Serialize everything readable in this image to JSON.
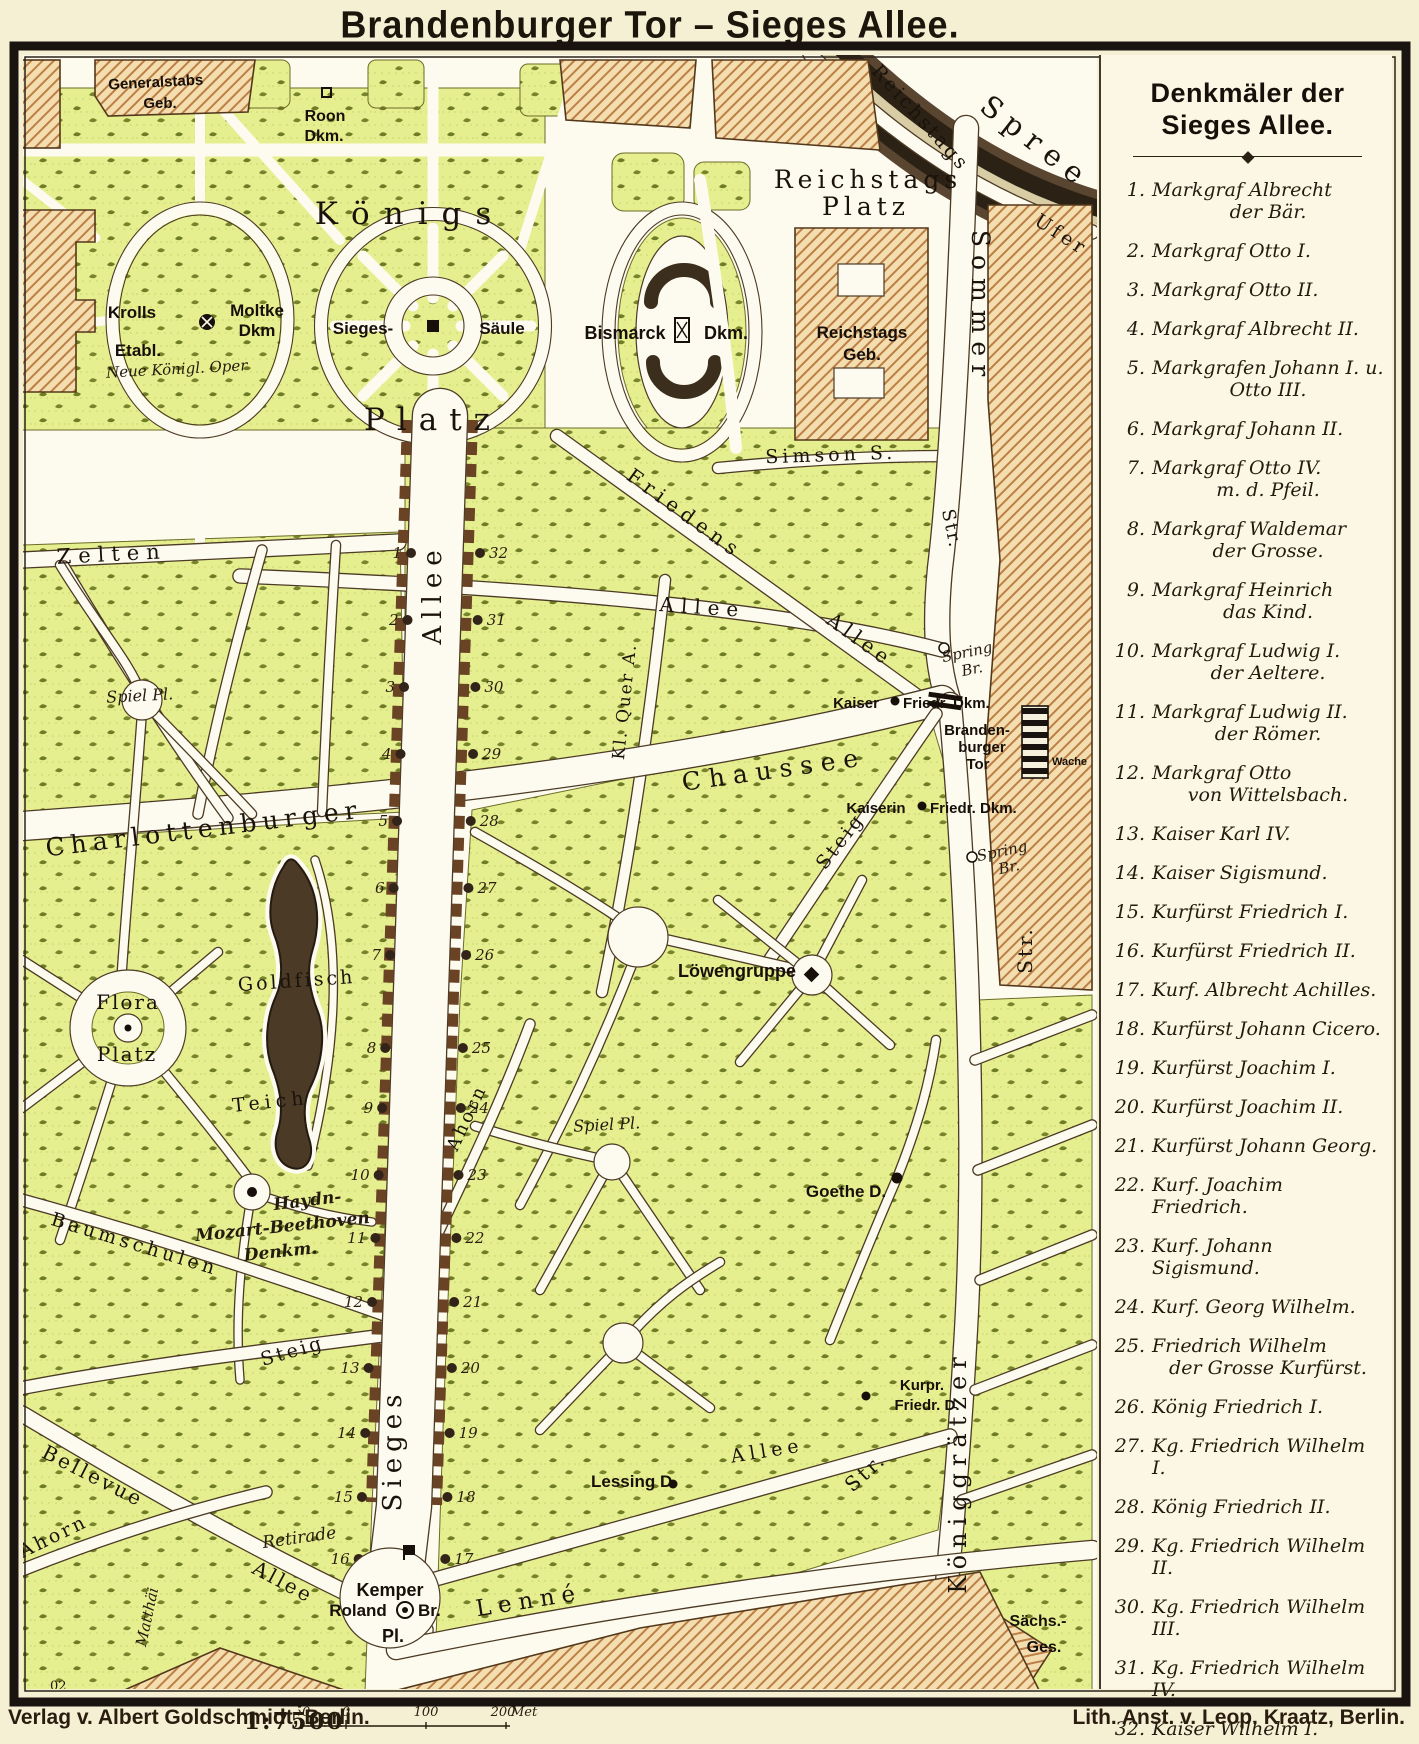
{
  "title": "Brandenburger Tor – Sieges Allee.",
  "colors": {
    "paper": "#f5efd3",
    "map_ground": "#fdfaee",
    "park_green": "#e6ef8f",
    "building_tan": "#f4deb0",
    "hatch_line": "#bc7f46",
    "river_dark": "#2b2115",
    "street_white": "#fdfbf0",
    "ink": "#1a130c",
    "pond": "#4a3a26"
  },
  "legend": {
    "title_line1": "Denkmäler der",
    "title_line2": "Sieges Allee.",
    "items": [
      {
        "n": "1.",
        "t": "Markgraf Albrecht",
        "t2": "der Bär."
      },
      {
        "n": "2.",
        "t": "Markgraf Otto I."
      },
      {
        "n": "3.",
        "t": "Markgraf Otto II."
      },
      {
        "n": "4.",
        "t": "Markgraf Albrecht II."
      },
      {
        "n": "5.",
        "t": "Markgrafen Johann I. u.",
        "t2": "Otto III."
      },
      {
        "n": "6.",
        "t": "Markgraf Johann II."
      },
      {
        "n": "7.",
        "t": "Markgraf Otto IV.",
        "t2": "m. d. Pfeil."
      },
      {
        "n": "8.",
        "t": "Markgraf Waldemar",
        "t2": "der Grosse."
      },
      {
        "n": "9.",
        "t": "Markgraf Heinrich",
        "t2": "das Kind."
      },
      {
        "n": "10.",
        "t": "Markgraf Ludwig I.",
        "t2": "der Aeltere."
      },
      {
        "n": "11.",
        "t": "Markgraf Ludwig II.",
        "t2": "der Römer."
      },
      {
        "n": "12.",
        "t": "Markgraf Otto",
        "t2": "von Wittelsbach."
      },
      {
        "n": "13.",
        "t": "Kaiser Karl IV."
      },
      {
        "n": "14.",
        "t": "Kaiser Sigismund."
      },
      {
        "n": "15.",
        "t": "Kurfürst Friedrich I."
      },
      {
        "n": "16.",
        "t": "Kurfürst Friedrich II."
      },
      {
        "n": "17.",
        "t": "Kurf. Albrecht Achilles."
      },
      {
        "n": "18.",
        "t": "Kurfürst Johann Cicero."
      },
      {
        "n": "19.",
        "t": "Kurfürst Joachim I."
      },
      {
        "n": "20.",
        "t": "Kurfürst Joachim II."
      },
      {
        "n": "21.",
        "t": "Kurfürst Johann Georg."
      },
      {
        "n": "22.",
        "t": "Kurf. Joachim Friedrich."
      },
      {
        "n": "23.",
        "t": "Kurf. Johann Sigismund."
      },
      {
        "n": "24.",
        "t": "Kurf. Georg Wilhelm."
      },
      {
        "n": "25.",
        "t": "Friedrich Wilhelm",
        "t2": "der Grosse Kurfürst."
      },
      {
        "n": "26.",
        "t": "König Friedrich I."
      },
      {
        "n": "27.",
        "t": "Kg. Friedrich Wilhelm I."
      },
      {
        "n": "28.",
        "t": "König Friedrich II."
      },
      {
        "n": "29.",
        "t": "Kg. Friedrich Wilhelm II."
      },
      {
        "n": "30.",
        "t": "Kg. Friedrich Wilhelm III."
      },
      {
        "n": "31.",
        "t": "Kg. Friedrich Wilhelm IV."
      },
      {
        "n": "32.",
        "t": "Kaiser Wilhelm I."
      }
    ]
  },
  "map": {
    "monument_numbers_west": [
      1,
      2,
      3,
      4,
      5,
      6,
      7,
      8,
      9,
      10,
      11,
      12,
      13,
      14,
      15,
      16
    ],
    "monument_numbers_east": [
      32,
      31,
      30,
      29,
      28,
      27,
      26,
      25,
      24,
      23,
      22,
      21,
      20,
      19,
      18,
      17
    ],
    "labels": {
      "generalstabs1": "Generalstabs",
      "generalstabs2": "Geb.",
      "roon1": "Roon",
      "roon2": "Dkm.",
      "koenigs": "Königs",
      "koenigs_platz": "Platz",
      "krolls1": "Krolls",
      "krolls2": "Etabl.",
      "oper": "Neue Königl. Oper",
      "moltke1": "Moltke",
      "moltke2": "Dkm",
      "sieges1": "Sieges-",
      "sieges2": "Säule",
      "bismarck1": "Bismarck",
      "bismarck2": "Dkm.",
      "rplatz1": "Reichstags",
      "rplatz2": "Platz",
      "rgeb1": "Reichstags",
      "rgeb2": "Geb.",
      "rufer1": "Reichstags",
      "rufer2": "Ufer",
      "spree": "Spree",
      "sommer": "Sommer",
      "sommer_str": "Str.",
      "simson": "Simson  S.",
      "zelten": "Zelten",
      "friedens": "Friedens",
      "friedens_allee": "Allee",
      "allee_mid": "Allee",
      "allee_vert": "Allee",
      "sieges_vert": "Sieges",
      "kl_quer": "Kl. Quer A.",
      "spring1a": "Spring",
      "spring1b": "Br.",
      "spring2a": "Spring",
      "spring2b": "Br.",
      "kaiser_a": "Kaiser",
      "kaiser_b": "Friedr. Dkm.",
      "kaiserin_a": "Kaiserin",
      "kaiserin_b": "Friedr. Dkm.",
      "tor1": "Branden-",
      "tor2": "burger",
      "tor3": "Tor",
      "wache": "Wache",
      "chaussee": "Chaussee",
      "charlottenburger": "Charlottenburger",
      "spiel1": "Spiel Pl.",
      "spiel2": "Spiel Pl.",
      "str_mid": "Str.",
      "flora1": "Flora",
      "flora2": "Platz",
      "goldfisch": "Goldfisch",
      "teich": "Teich",
      "haydn1": "Haydn-",
      "haydn2": "Mozart-Beethoven",
      "haydn3": "Denkm.",
      "baumschulen": "Baumschulen",
      "loewengruppe": "Löwengruppe",
      "goethe": "Goethe D.",
      "ahorn_mid": "Ahorn",
      "ahorn_left": "Ahorn",
      "steig_left": "Steig",
      "steig_right": "Steig",
      "kurpr1": "Kurpr.",
      "kurpr2": "Friedr. D.",
      "lessing": "Lessing D.",
      "bellevue": "Bellevue",
      "bellevue_allee": "Allee",
      "matthaei": "Matthäi",
      "retirade": "Retirade",
      "kemper": "Kemper",
      "roland": "Roland",
      "roland_br": "Br.",
      "kemper_pl": "Pl.",
      "lenne": "Lenné",
      "allee_se": "Allee",
      "str_se": "Str.",
      "koeniggraetzer": "Königgrätzer",
      "saechs1": "Sächs.-",
      "saechs2": "Ges.",
      "corner": "02"
    }
  },
  "credits": {
    "left": "Verlag v. Albert Goldschmidt, Berlin.",
    "right": "Lith. Anst. v. Leop. Kraatz, Berlin.",
    "ratio": "1:7500",
    "scale_labels": [
      "50",
      "0",
      "100",
      "200"
    ],
    "scale_unit": "Meter"
  }
}
